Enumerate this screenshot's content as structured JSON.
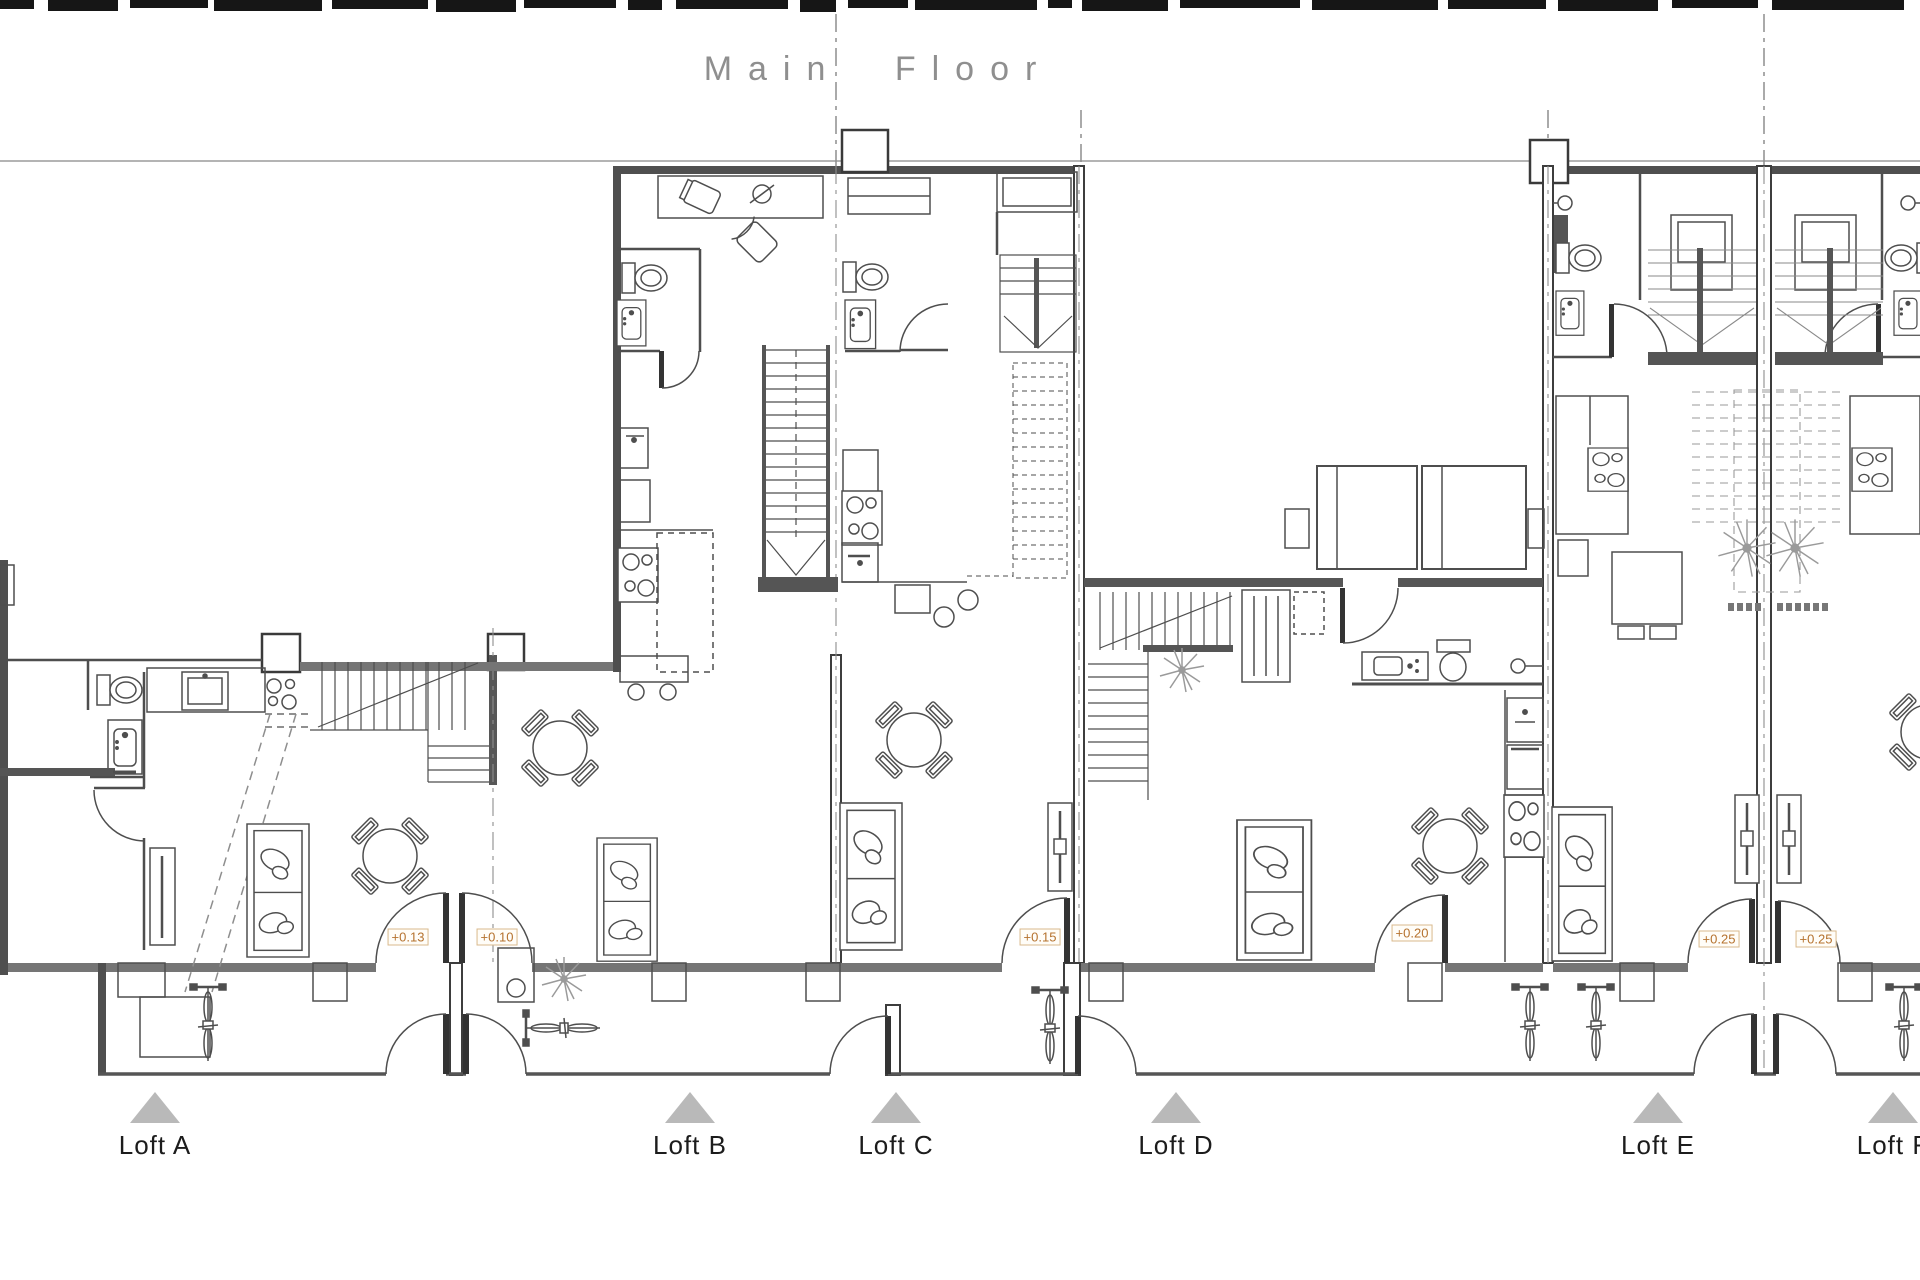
{
  "title": "Main Floor",
  "units": [
    {
      "id": "loft-a",
      "label": "Loft A",
      "x": 155
    },
    {
      "id": "loft-b",
      "label": "Loft B",
      "x": 690
    },
    {
      "id": "loft-c",
      "label": "Loft C",
      "x": 896
    },
    {
      "id": "loft-d",
      "label": "Loft D",
      "x": 1176
    },
    {
      "id": "loft-e",
      "label": "Loft E",
      "x": 1658
    },
    {
      "id": "loft-f",
      "label": "Loft F",
      "x": 1893
    }
  ],
  "elevation_markers": [
    {
      "value": "+0.13",
      "x": 408,
      "y": 937
    },
    {
      "value": "+0.10",
      "x": 497,
      "y": 937
    },
    {
      "value": "+0.15",
      "x": 1040,
      "y": 937
    },
    {
      "value": "+0.20",
      "x": 1412,
      "y": 933
    },
    {
      "value": "+0.25",
      "x": 1719,
      "y": 939
    },
    {
      "value": "+0.25",
      "x": 1816,
      "y": 939
    }
  ],
  "colors": {
    "title": "#8f8f8f",
    "triangle": "#b9b9b9",
    "label": "#1c1c1c",
    "accent": "#b5722e",
    "accent_border": "#d9b98c",
    "wall_dark": "#4d4d4d",
    "wall_gray": "#757575",
    "line": "#4e4e4e"
  }
}
